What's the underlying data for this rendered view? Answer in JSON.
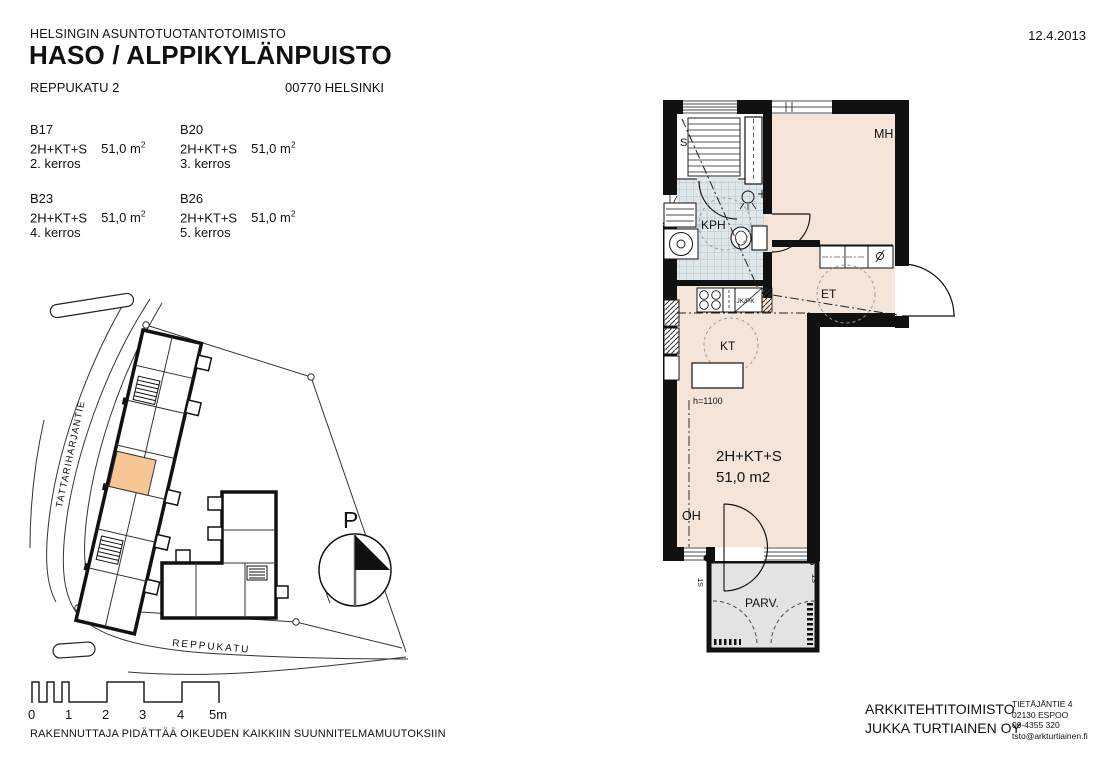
{
  "header": {
    "organization": "HELSINGIN ASUNTOTUOTANTOTOIMISTO",
    "project_title": "HASO / ALPPIKYLÄNPUISTO",
    "street_address": "REPPUKATU 2",
    "postal_city": "00770 HELSINKI",
    "date": "12.4.2013"
  },
  "apartments": [
    {
      "id": "B17",
      "type": "2H+KT+S",
      "area": "51,0 m",
      "area_sup": "2",
      "floor": "2. kerros"
    },
    {
      "id": "B20",
      "type": "2H+KT+S",
      "area": "51,0 m",
      "area_sup": "2",
      "floor": "3. kerros"
    },
    {
      "id": "B23",
      "type": "2H+KT+S",
      "area": "51,0 m",
      "area_sup": "2",
      "floor": "4. kerros"
    },
    {
      "id": "B26",
      "type": "2H+KT+S",
      "area": "51,0 m",
      "area_sup": "2",
      "floor": "5. kerros"
    }
  ],
  "site_plan": {
    "street_side": "TATTARIHARJANTIE",
    "street_bottom": "REPPUKATU",
    "north_label": "P"
  },
  "scale_bar": {
    "ticks": [
      "0",
      "1",
      "2",
      "3",
      "4",
      "5m"
    ]
  },
  "floor_plan": {
    "rooms": {
      "sauna": "S",
      "bathroom": "KPH",
      "bedroom": "MH",
      "hall": "ET",
      "kitchen": "KT",
      "living": "OH",
      "balcony": "PARV."
    },
    "apartment_label": {
      "type": "2H+KT+S",
      "area": "51,0 m2"
    },
    "annotations": {
      "counter_height": "h=1100",
      "fridge_freezer": "JK/PK",
      "balcony_post_left": "ST",
      "balcony_post_right": "ST"
    }
  },
  "footer": {
    "disclaimer": "RAKENNUTTAJA PIDÄTTÄÄ OIKEUDEN KAIKKIIN SUUNNITELMAMUUTOKSIIN",
    "architect_firm_line1": "ARKKITEHTITOIMISTO",
    "architect_firm_line2": "JUKKA TURTIAINEN OY",
    "architect_address_line1": "TIETÄJÄNTIE 4",
    "architect_address_line2": "02130 ESPOO",
    "architect_phone": "09-4355 320",
    "architect_email": "tsto@arkturtiainen.fi"
  },
  "colors": {
    "room_fill": "#f5e5d8",
    "bathroom_tile": "#dfe7ea",
    "balcony_fill": "#e3e3e3",
    "highlight_unit": "#f6c795",
    "wall": "#111111"
  }
}
